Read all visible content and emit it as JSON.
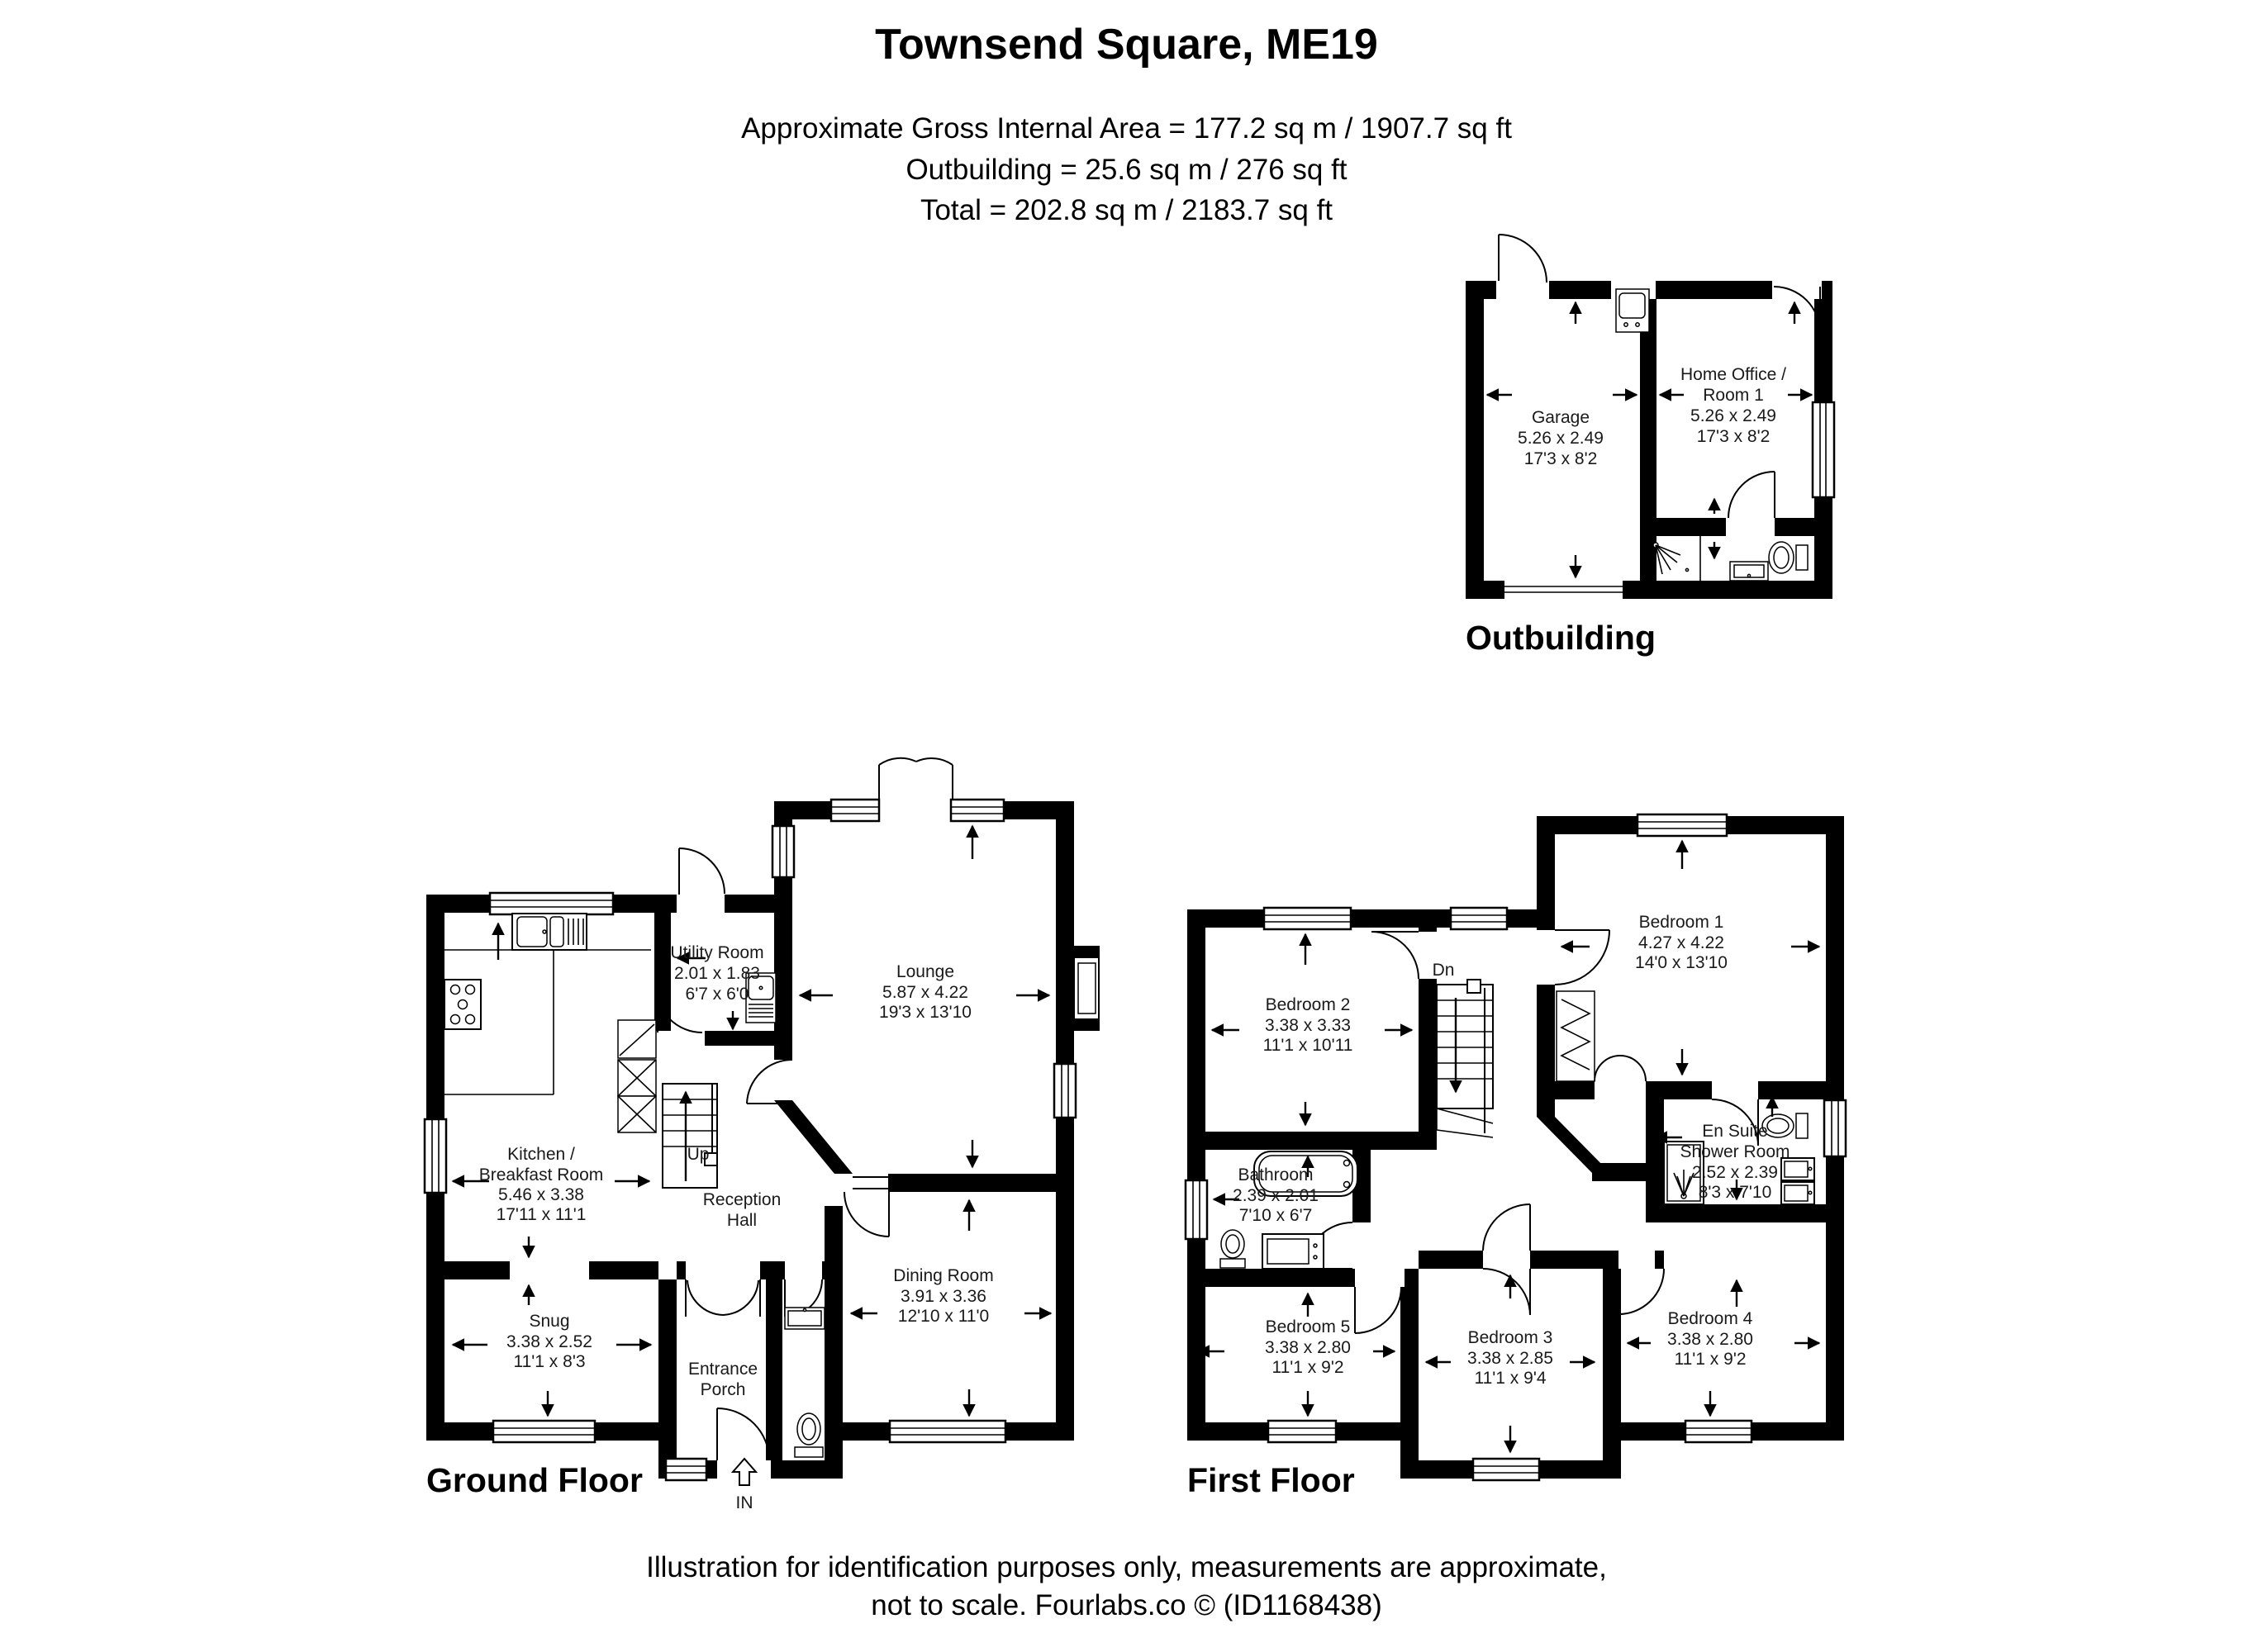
{
  "title": "Townsend Square, ME19",
  "areas": {
    "line1": "Approximate Gross Internal Area = 177.2 sq m / 1907.7 sq ft",
    "line2": "Outbuilding = 25.6 sq m / 276 sq ft",
    "line3": "Total = 202.8 sq m / 2183.7 sq ft"
  },
  "footer": {
    "line1": "Illustration for identification purposes only, measurements are approximate,",
    "line2": "not to scale. Fourlabs.co © (ID1168438)"
  },
  "outbuilding": {
    "label": "Outbuilding",
    "garage": {
      "lines": [
        "Garage",
        "5.26 x 2.49",
        "17'3 x 8'2"
      ]
    },
    "home_office": {
      "lines": [
        "Home Office /",
        "Room 1",
        "5.26 x 2.49",
        "17'3 x 8'2"
      ]
    }
  },
  "ground_floor": {
    "label": "Ground Floor",
    "up": "Up",
    "in": "IN",
    "utility": {
      "lines": [
        "Utility Room",
        "2.01 x 1.83",
        "6'7 x 6'0"
      ]
    },
    "lounge": {
      "lines": [
        "Lounge",
        "5.87 x 4.22",
        "19'3 x 13'10"
      ]
    },
    "kitchen": {
      "lines": [
        "Kitchen /",
        "Breakfast Room",
        "5.46 x 3.38",
        "17'11 x 11'1"
      ]
    },
    "reception": {
      "lines": [
        "Reception",
        "Hall"
      ]
    },
    "snug": {
      "lines": [
        "Snug",
        "3.38 x 2.52",
        "11'1 x 8'3"
      ]
    },
    "dining": {
      "lines": [
        "Dining Room",
        "3.91 x 3.36",
        "12'10 x 11'0"
      ]
    },
    "porch": {
      "lines": [
        "Entrance",
        "Porch"
      ]
    }
  },
  "first_floor": {
    "label": "First Floor",
    "dn": "Dn",
    "bedroom2": {
      "lines": [
        "Bedroom 2",
        "3.38 x 3.33",
        "11'1 x 10'11"
      ]
    },
    "bedroom1": {
      "lines": [
        "Bedroom 1",
        "4.27 x 4.22",
        "14'0 x 13'10"
      ]
    },
    "bathroom": {
      "lines": [
        "Bathroom",
        "2.39 x 2.01",
        "7'10 x 6'7"
      ]
    },
    "ensuite": {
      "lines": [
        "En Suite",
        "Shower Room",
        "2.52 x 2.39",
        "8'3 x 7'10"
      ]
    },
    "bedroom5": {
      "lines": [
        "Bedroom 5",
        "3.38 x 2.80",
        "11'1 x 9'2"
      ]
    },
    "bedroom3": {
      "lines": [
        "Bedroom 3",
        "3.38 x 2.85",
        "11'1 x 9'4"
      ]
    },
    "bedroom4": {
      "lines": [
        "Bedroom 4",
        "3.38 x 2.80",
        "11'1 x 9'2"
      ]
    }
  }
}
